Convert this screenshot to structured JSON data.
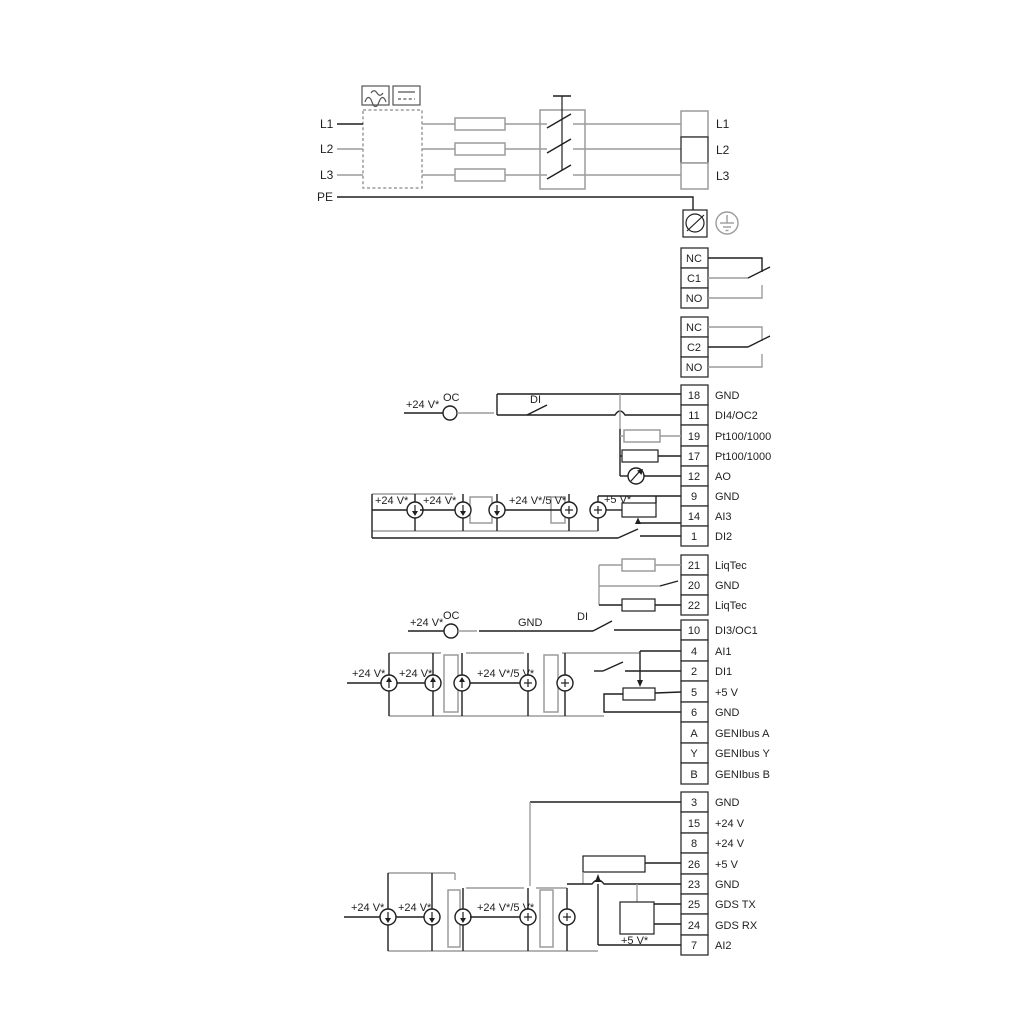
{
  "power": {
    "inputs": [
      "L1",
      "L2",
      "L3",
      "PE"
    ],
    "outputs": [
      "L1",
      "L2",
      "L3"
    ]
  },
  "relay1": [
    "NC",
    "C1",
    "NO"
  ],
  "relay2": [
    "NC",
    "C2",
    "NO"
  ],
  "blockA": [
    {
      "n": "18",
      "l": "GND"
    },
    {
      "n": "11",
      "l": "DI4/OC2"
    },
    {
      "n": "19",
      "l": "Pt100/1000"
    },
    {
      "n": "17",
      "l": "Pt100/1000"
    },
    {
      "n": "12",
      "l": "AO"
    },
    {
      "n": "9",
      "l": "GND"
    },
    {
      "n": "14",
      "l": "AI3"
    },
    {
      "n": "1",
      "l": "DI2"
    }
  ],
  "blockL": [
    {
      "n": "21",
      "l": "LiqTec"
    },
    {
      "n": "20",
      "l": "GND"
    },
    {
      "n": "22",
      "l": "LiqTec"
    }
  ],
  "blockB": [
    {
      "n": "10",
      "l": "DI3/OC1"
    },
    {
      "n": "4",
      "l": "AI1"
    },
    {
      "n": "2",
      "l": "DI1"
    },
    {
      "n": "5",
      "l": "+5 V"
    },
    {
      "n": "6",
      "l": "GND"
    },
    {
      "n": "A",
      "l": "GENIbus A"
    },
    {
      "n": "Y",
      "l": "GENIbus Y"
    },
    {
      "n": "B",
      "l": "GENIbus B"
    }
  ],
  "blockC": [
    {
      "n": "3",
      "l": "GND"
    },
    {
      "n": "15",
      "l": "+24 V"
    },
    {
      "n": "8",
      "l": "+24 V"
    },
    {
      "n": "26",
      "l": "+5 V"
    },
    {
      "n": "23",
      "l": "GND"
    },
    {
      "n": "25",
      "l": "GDS TX"
    },
    {
      "n": "24",
      "l": "GDS RX"
    },
    {
      "n": "7",
      "l": "AI2"
    }
  ],
  "notes": {
    "v24": "+24 V*",
    "v24_5": "+24 V*/5 V*",
    "v5": "+5 V*",
    "oc": "OC",
    "di": "DI",
    "gnd": "GND"
  },
  "colors": {
    "wire": "#1f1f1f",
    "wire_gray": "#9c9c9c"
  }
}
